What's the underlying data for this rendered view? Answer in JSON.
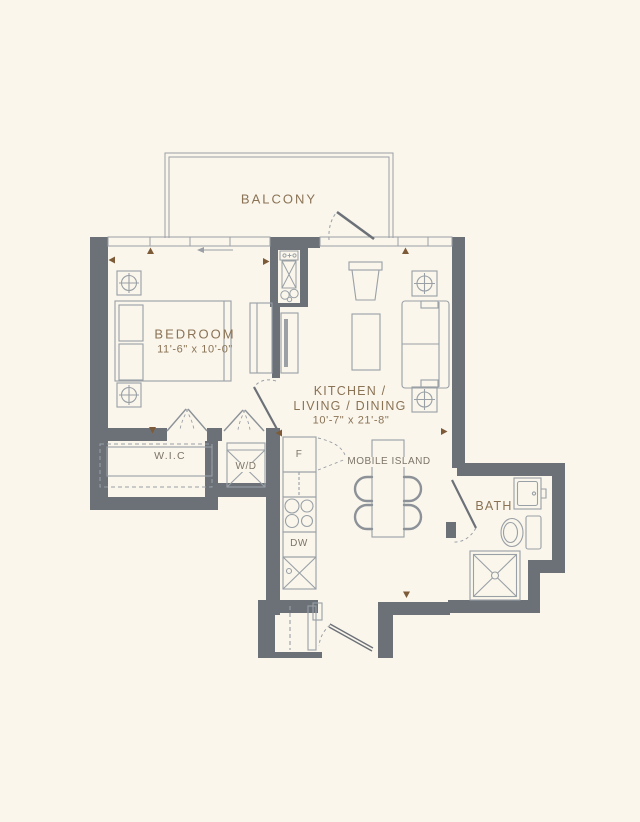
{
  "plan": {
    "title": "one-bedroom-floorplan",
    "colors": {
      "background": "#FAF6EC",
      "walls": "#6C7178",
      "lines": "#9AA0A6",
      "room_label": "#8A7355",
      "small_label": "#7C7467",
      "arrow": "#7D5B38"
    },
    "rooms": {
      "balcony": {
        "label": "BALCONY"
      },
      "bedroom": {
        "label": "BEDROOM",
        "dims": "11'-6\" x 10'-0\""
      },
      "living": {
        "label_line1": "KITCHEN /",
        "label_line2": "LIVING / DINING",
        "dims": "10'-7\" x 21'-8\""
      },
      "wic": {
        "label": "W.I.C"
      },
      "bath": {
        "label": "BATH"
      },
      "island": {
        "label": "MOBILE ISLAND"
      }
    },
    "appliances": {
      "washer_dryer": "W/D",
      "fridge": "F",
      "dishwasher": "DW"
    }
  }
}
